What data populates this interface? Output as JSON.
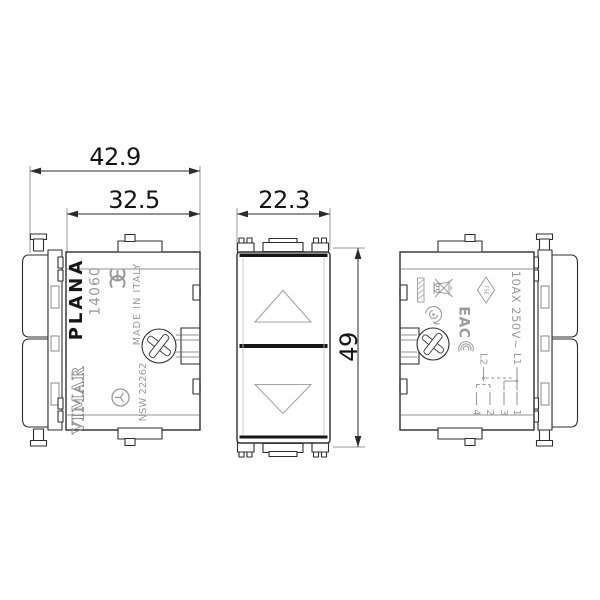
{
  "dimensions": {
    "overall_depth": "42.9",
    "body_depth": "32.5",
    "module_width": "22.3",
    "module_height": "49"
  },
  "left_view": {
    "series": "PLANA",
    "article": "14060",
    "made_in": "MADE IN ITALY",
    "brand": "VIMAR",
    "code": "NSW 22262"
  },
  "right_view": {
    "rating": "10AX 250V~",
    "eac_mark": "EAC",
    "tse_mark": "TSE",
    "schematic": {
      "l1": "L1",
      "l2": "L2",
      "terminal_1": "1",
      "terminal_3": "3",
      "terminal_2": "2",
      "terminal_4": "4"
    }
  },
  "icons": {
    "ce": "ce-mark-icon",
    "certification_circle": "certification-circle-icon",
    "weee": "weee-bin-icon",
    "push_operation": "push-operation-icon",
    "ccc": "ccc-mark-icon",
    "tse_diamond": "tse-diamond-icon",
    "screw": "phillips-screw-icon",
    "up_arrow": "up-arrow-icon",
    "down_arrow": "down-arrow-icon"
  },
  "colors": {
    "line": "#2e2e2e",
    "marking": "#9b9b9b",
    "dark_band": "#161616",
    "background": "#ffffff"
  }
}
